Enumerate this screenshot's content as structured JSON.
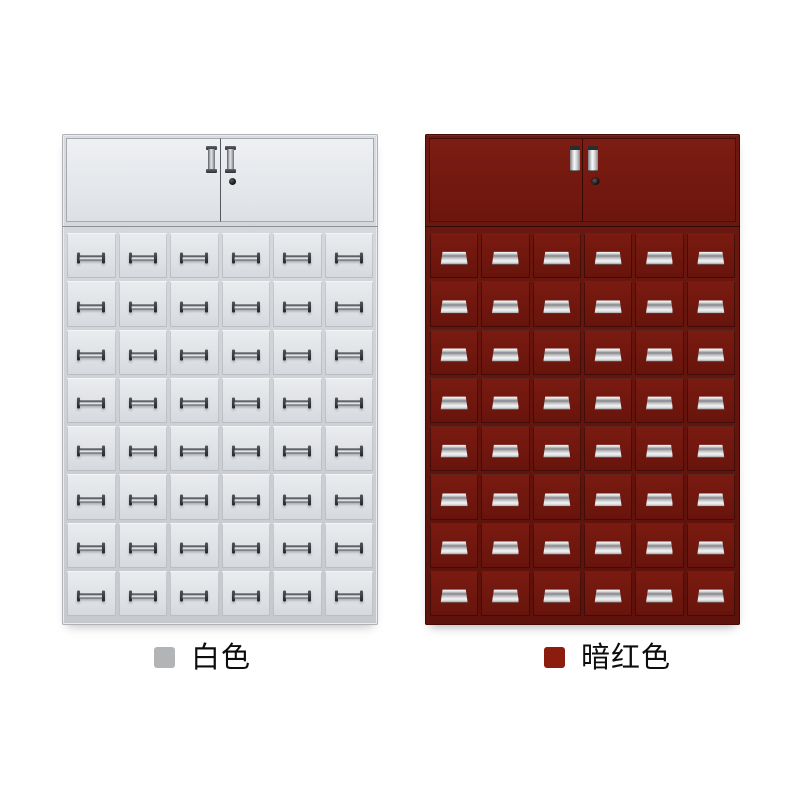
{
  "page": {
    "background_color": "#ffffff"
  },
  "variants": [
    {
      "name": "white",
      "label": "白色",
      "swatch_color": "#b3b4b6",
      "cabinet_color": "#dde0e4",
      "cabinet": {
        "style": "white",
        "doors": 2,
        "drawer_rows": 8,
        "drawer_columns": 6,
        "drawer_count": 48,
        "has_lock": true,
        "handle_color": "#2e3135"
      }
    },
    {
      "name": "dark-red",
      "label": "暗红色",
      "swatch_color": "#8b1d0e",
      "cabinet_color": "#71180f",
      "cabinet": {
        "style": "dark-red",
        "doors": 2,
        "drawer_rows": 8,
        "drawer_columns": 6,
        "drawer_count": 48,
        "has_lock": true,
        "handle_color": "#d8d9db"
      }
    }
  ]
}
